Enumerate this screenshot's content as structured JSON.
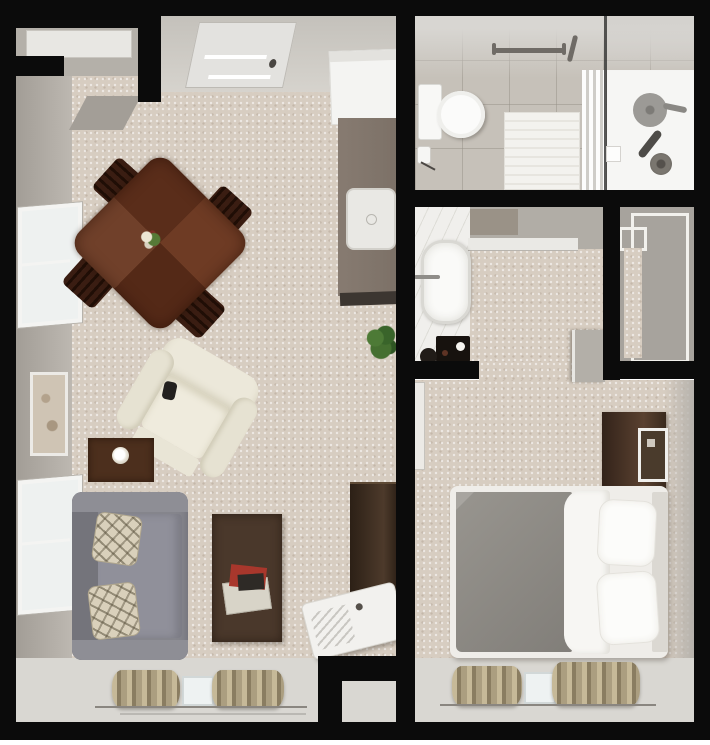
{
  "meta": {
    "title": "Studio apartment 3D floor plan, top-down view",
    "type": "floor-plan",
    "text_on_image": "none"
  },
  "palette": {
    "wall_black": "#0b0b0b",
    "carpet_beige": "#d7cdc1",
    "bath_tile_gray": "#c6c1b9",
    "hard_floor_gray": "#d9d7d2",
    "marble_white": "#f0efec",
    "wood_dark": "#3a2418",
    "dining_wood": "#5f3320",
    "sofa_gray": "#85858c",
    "duvet_gray": "#8f8c87",
    "recliner_cream": "#ece8da",
    "curtain_tan": "#b3a68a",
    "plant_green": "#44702f",
    "fixture_white": "#fbfbfa"
  },
  "rooms": [
    {
      "name": "Living / dining room with kitchenette"
    },
    {
      "name": "Bathroom with roll-in shower"
    },
    {
      "name": "Dressing area with soaking tub"
    },
    {
      "name": "Closet"
    },
    {
      "name": "Bedroom"
    }
  ],
  "furniture": {
    "living": [
      "entry door",
      "coat closet shelf",
      "dining table",
      "dining chair x4",
      "floral centerpiece",
      "refrigerator",
      "kitchenette counter",
      "counter sink",
      "potted plant",
      "recliner",
      "side table with lamp",
      "sofa",
      "plaid throw pillow x2",
      "coffee table",
      "magazines",
      "tall wardrobe cabinet",
      "white utility unit",
      "window x2",
      "framed wall art",
      "patio curtains x2",
      "sliding patio door"
    ],
    "bathroom": [
      "toilet",
      "toilet paper holder",
      "grab bar straight",
      "grab bar angled",
      "bath mat",
      "shower curtain",
      "glass shower partition",
      "wall shower head",
      "hand shower wand",
      "floor drain",
      "soap dish"
    ],
    "dressing_area": [
      "soaking tub",
      "tub faucet",
      "marble deck",
      "black bath tray",
      "waste bin",
      "storage alcove shelf",
      "swing door (open)"
    ],
    "closet": [
      "sliding door frame large",
      "sliding door frame small",
      "carpet runner"
    ],
    "bedroom": [
      "bed with gray duvet",
      "folded white sheet",
      "pillow x2",
      "headboard",
      "dresser with mirror",
      "open entry door leaf",
      "patio curtains x2",
      "sliding patio door"
    ]
  }
}
